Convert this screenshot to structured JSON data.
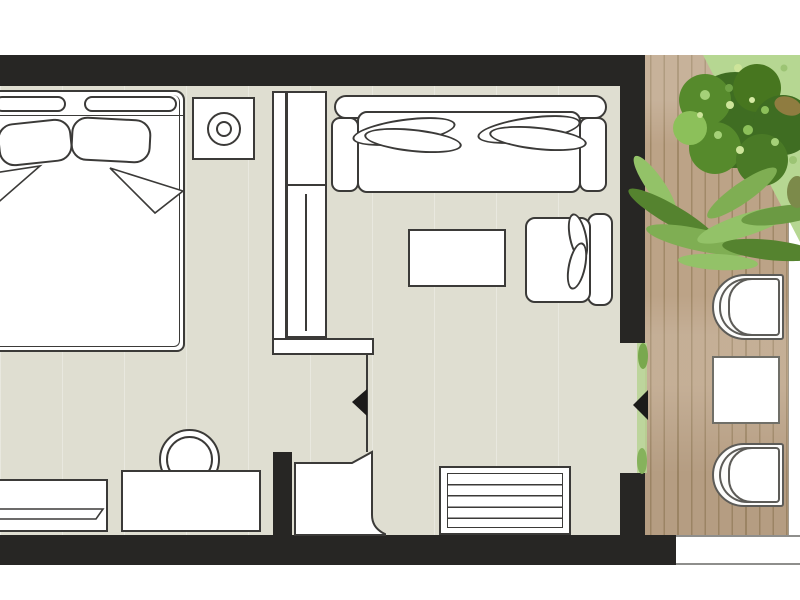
{
  "scene": {
    "kind": "floor-plan",
    "label": "Hotel room floor plan with furnished terrace"
  },
  "colors": {
    "wall": "#272624",
    "line": "#3b3a38",
    "line_soft": "#5d5c58",
    "floor": "#dfded1",
    "deck": "#bca387",
    "deck_seam": "#a18968",
    "band_line": "#8e8e8c",
    "grass": "#b6d792",
    "grass_light": "#cde49a",
    "bush_dark": "#3f6d22",
    "bush_mid": "#568a2c",
    "bush_light": "#8cc05a",
    "fern": "#7fae53",
    "fern_dark": "#55832f",
    "fern_light": "#93c268",
    "white": "#ffffff"
  },
  "furniture": {
    "bed": "Double bed",
    "headboard_cushion": "Headboard cushion",
    "pillow": "Pillow",
    "nightstand": "Bedside table",
    "lamp": "Table lamp",
    "wardrobe": "Wardrobe",
    "wardrobe_rail": "Wardrobe hanging rail",
    "sofa": "Sofa",
    "sofa_cushion": "Sofa cushion",
    "coffee_table": "Coffee table",
    "armchair": "Armchair",
    "tv_console": "Drawer console",
    "desk": "Desk",
    "desk_chair": "Desk chair",
    "bench": "Luggage bench",
    "entry_door": "Entrance door leaf",
    "entry_arrow": "Entrance direction marker",
    "terrace_arrow": "Terrace door direction marker",
    "terrace": "Wooden terrace deck",
    "terrace_edge": "Terrace edge step",
    "lounger": "Sun lounger",
    "terrace_table": "Terrace side table",
    "plants": "Garden plants",
    "lawn": "Lawn"
  }
}
